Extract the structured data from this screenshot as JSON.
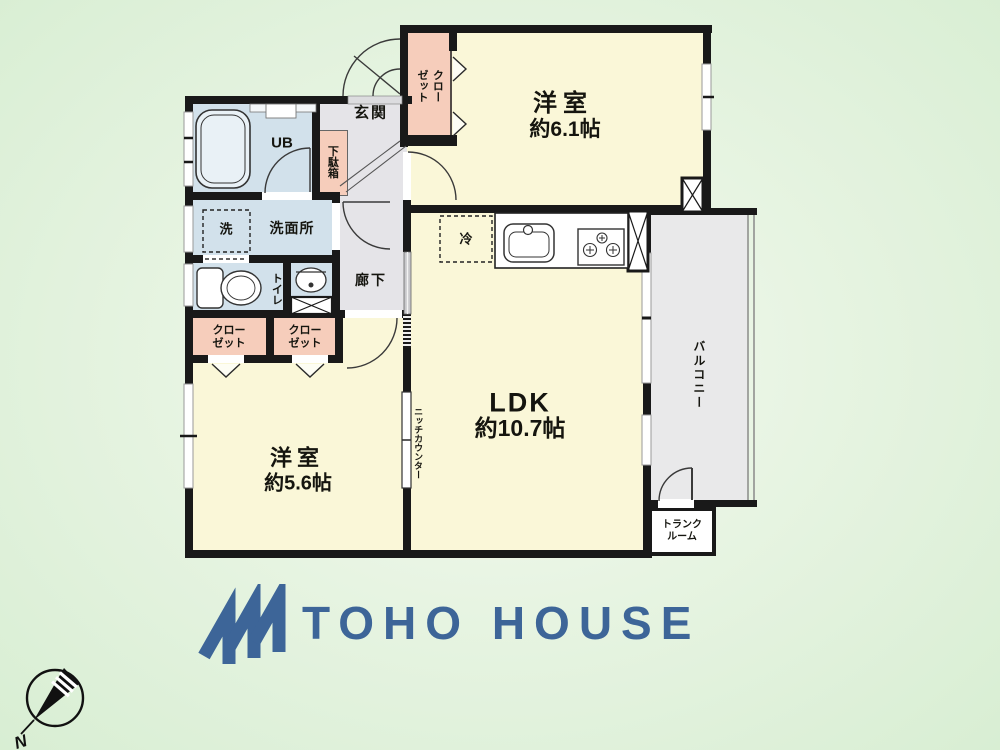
{
  "branding": {
    "logo_text": "TOHO HOUSE"
  },
  "compass": {
    "north_label": "N"
  },
  "rooms": {
    "bedroom1": {
      "name": "洋室",
      "size": "約6.1帖"
    },
    "ldk": {
      "name": "LDK",
      "size": "約10.7帖"
    },
    "bedroom2": {
      "name": "洋室",
      "size": "約5.6帖"
    },
    "balcony": "バルコニー",
    "entrance": "玄関",
    "hallway": "廊下",
    "washroom": "洗面所",
    "unit_bath": "UB",
    "toilet": "トイレ",
    "trunk_room": "トランク\nルーム"
  },
  "fixtures": {
    "closet_top": "クロー\nゼット",
    "closet_left": "クロー\nゼット",
    "closet_right": "クロー\nゼット",
    "shoe_cabinet": "下駄箱",
    "washer": "洗",
    "fridge": "冷",
    "niche_counter": "ニッチカウンター"
  },
  "colors": {
    "wall": "#191919",
    "room_cream": "#faf7d8",
    "wet_area_blue": "#d2e1eb",
    "closet_pink": "#f6cdbb",
    "hall_gray": "#e5e4e8",
    "balcony_gray": "#e9e9ea",
    "logo_blue": "#3d6598",
    "background_green": "#d8eed3"
  }
}
